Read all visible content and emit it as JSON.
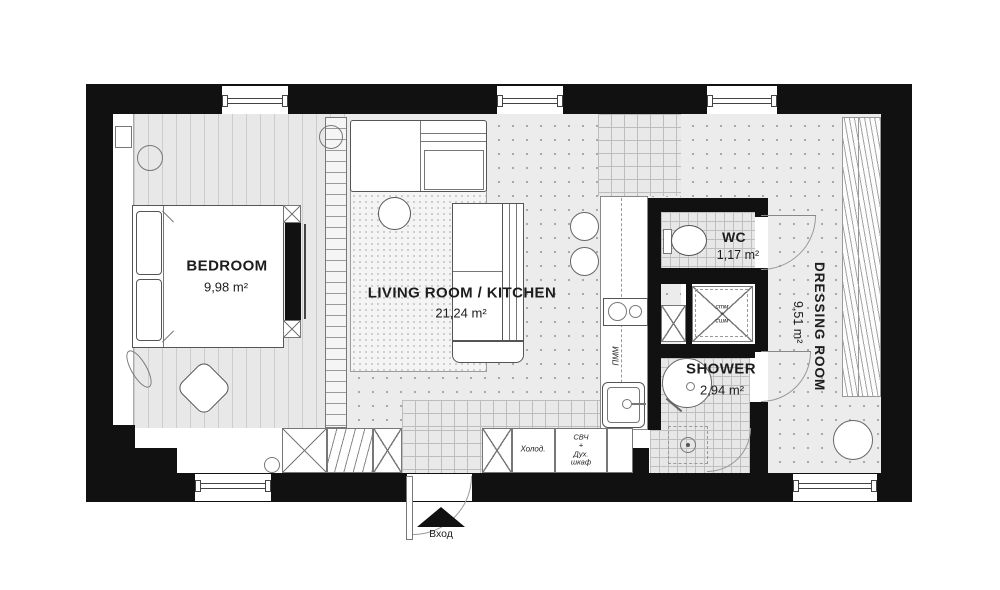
{
  "rooms": {
    "bedroom": {
      "name": "BEDROOM",
      "area": "9,98 m²"
    },
    "living": {
      "name": "LIVING ROOM / KITCHEN",
      "area": "21,24 m²"
    },
    "wc": {
      "name": "WC",
      "area": "1,17 m²"
    },
    "shower": {
      "name": "SHOWER",
      "area": "2,94 m²"
    },
    "dressing": {
      "name": "DRESSING ROOM",
      "area": "9,51 m²"
    }
  },
  "appliances": {
    "fridge": "Холод.",
    "microwave_oven": "СВЧ\n+\nДух.\nшкаф",
    "dishwasher": "ПММ",
    "washer_dryer": "стм\n+\nсшм"
  },
  "entrance": {
    "label": "Вход"
  },
  "colors": {
    "wall": "#111111",
    "floor_light": "#ececec",
    "label_text": "#1d1d1d"
  }
}
